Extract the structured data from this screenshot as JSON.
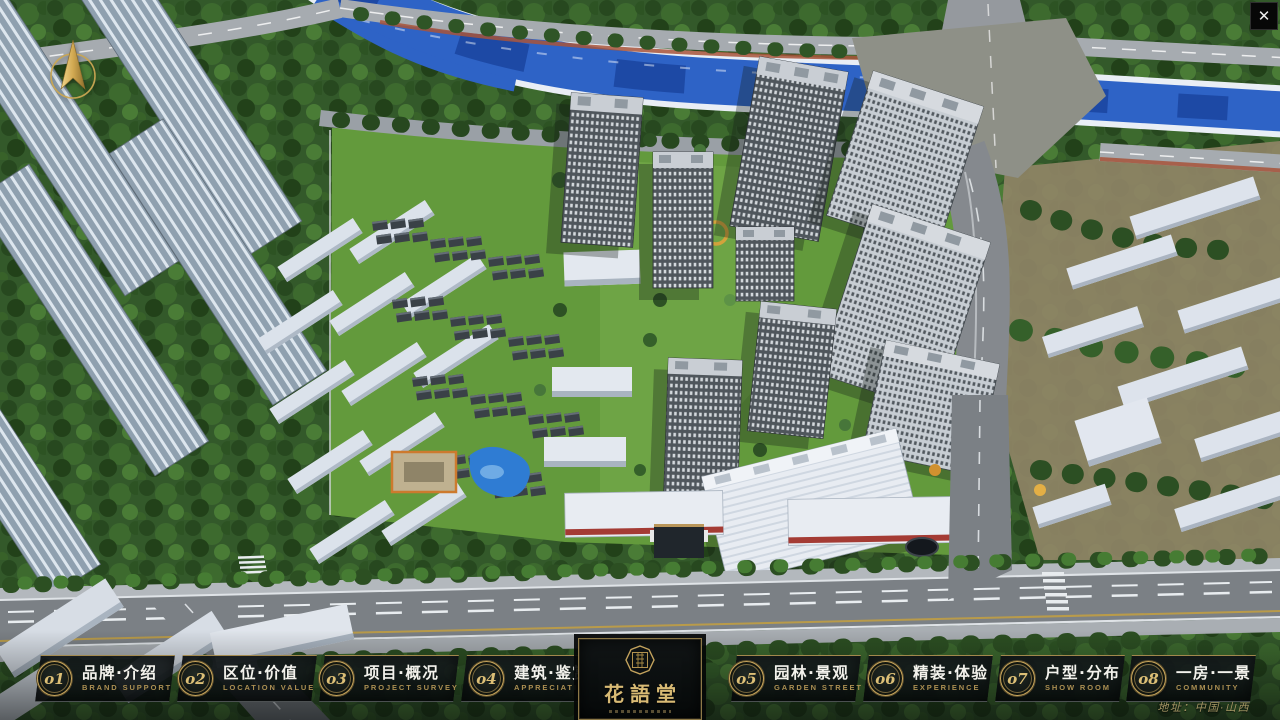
{
  "chrome": {
    "close_glyph": "✕"
  },
  "nav": {
    "items": [
      {
        "num": "o1",
        "zh": "品牌·介绍",
        "en": "BRAND SUPPORT"
      },
      {
        "num": "o2",
        "zh": "区位·价值",
        "en": "LOCATION VALUE"
      },
      {
        "num": "o3",
        "zh": "项目·概况",
        "en": "PROJECT SURVEY"
      },
      {
        "num": "o4",
        "zh": "建筑·鉴赏",
        "en": "APPRECIATION"
      },
      {
        "num": "o5",
        "zh": "园林·景观",
        "en": "GARDEN STREET"
      },
      {
        "num": "o6",
        "zh": "精装·体验",
        "en": "EXPERIENCE"
      },
      {
        "num": "o7",
        "zh": "户型·分布",
        "en": "SHOW ROOM"
      },
      {
        "num": "o8",
        "zh": "一房·一景",
        "en": "COMMUNITY"
      }
    ]
  },
  "logo": {
    "title": "花語堂"
  },
  "footer": {
    "address": "地址：中国·山西"
  },
  "theme": {
    "gold": "#c8a65c",
    "gold_dim": "#ab8f52",
    "text_light": "#f3f2ec"
  },
  "scene": {
    "river_blue": "#2e63c6",
    "forest_green": "#33592a",
    "lawn_green": "#639a3c",
    "road_grey": "#7b8085",
    "tower_facade": "#565d63",
    "tower_facade_light": "#c7cdd3",
    "tower_roof": "#c9ced4",
    "slab_white": "#dbe2eb",
    "ground_tan": "#8f8466",
    "pool_blue": "#2f7cd3",
    "accent_orange": "#cd7a2e"
  }
}
